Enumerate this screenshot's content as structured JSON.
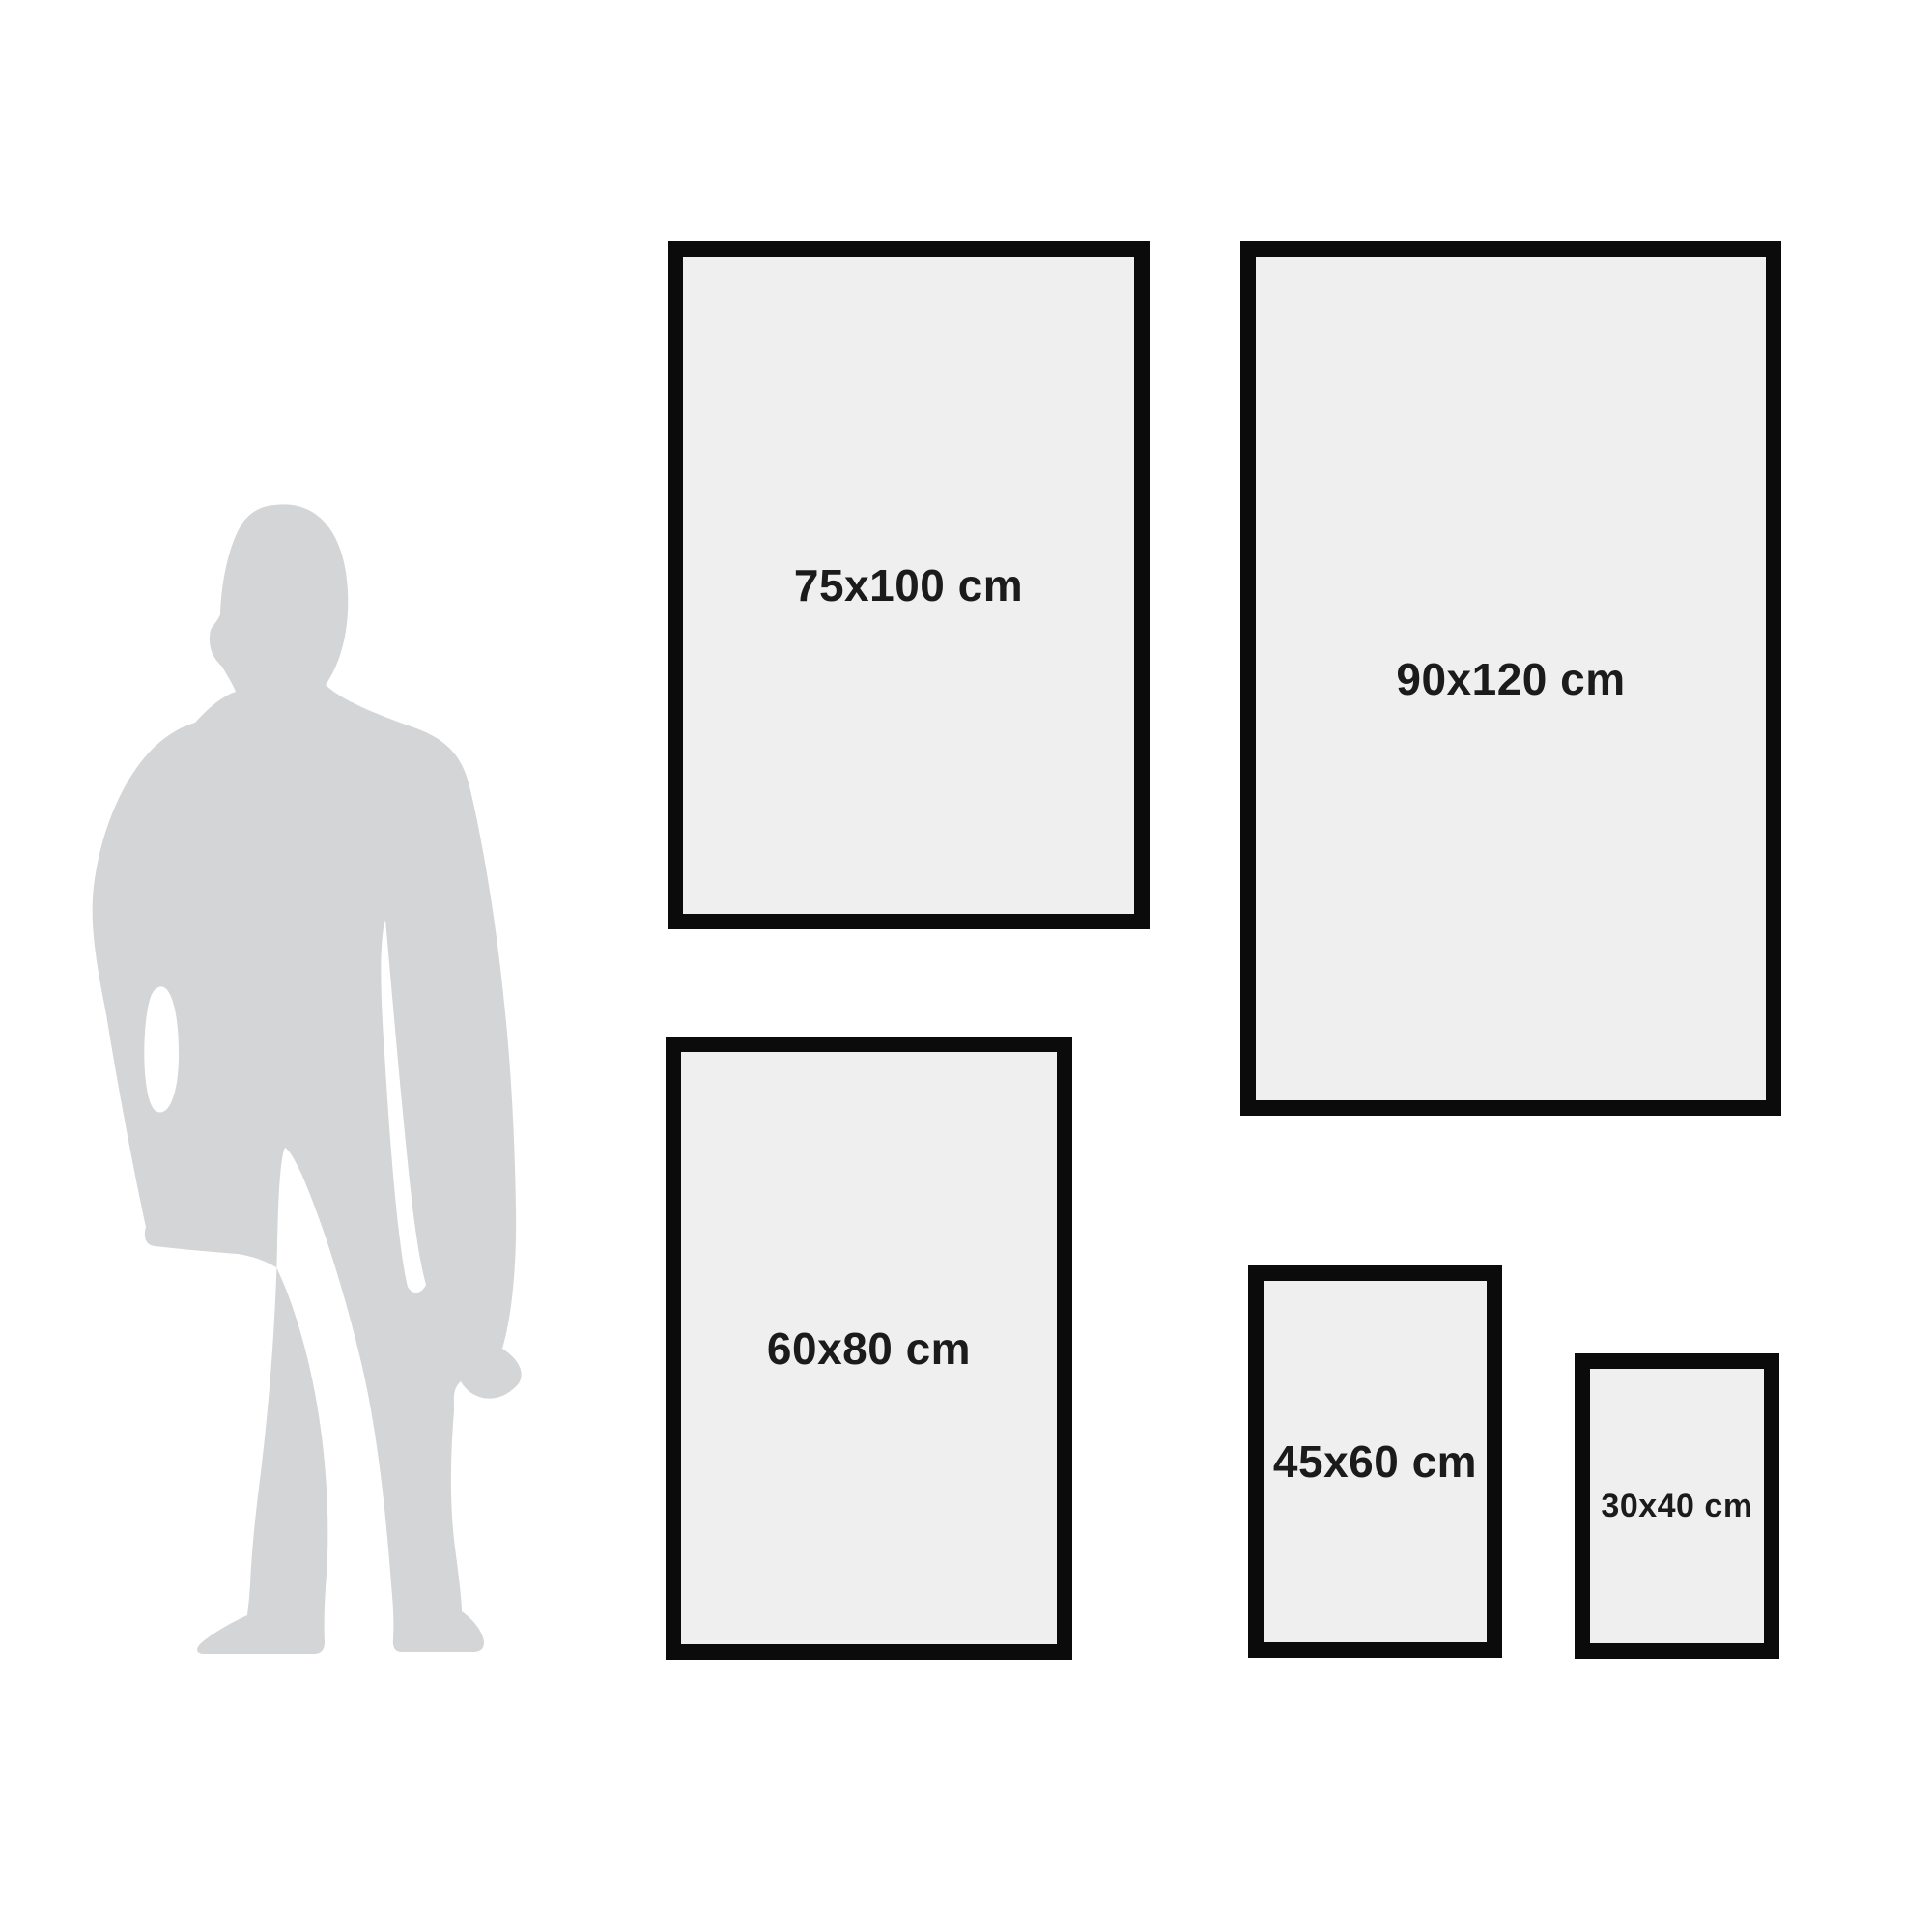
{
  "diagram": {
    "description": "Poster size comparison guide with human silhouette for scale",
    "person": {
      "name": "standing man silhouette",
      "pose": "standing, facing slightly left, one hand in pocket"
    }
  },
  "frames": [
    {
      "label": "75x100 cm",
      "width_cm": 75,
      "height_cm": 100
    },
    {
      "label": "90x120 cm",
      "width_cm": 90,
      "height_cm": 120
    },
    {
      "label": "60x80 cm",
      "width_cm": 60,
      "height_cm": 80
    },
    {
      "label": "45x60 cm",
      "width_cm": 45,
      "height_cm": 60
    },
    {
      "label": "30x40 cm",
      "width_cm": 30,
      "height_cm": 40
    }
  ],
  "colors": {
    "background": "#ffffff",
    "frame_border": "#0b0b0b",
    "frame_fill": "#efefef",
    "label_text": "#1b1b1b",
    "silhouette": "#d4d5d7"
  }
}
